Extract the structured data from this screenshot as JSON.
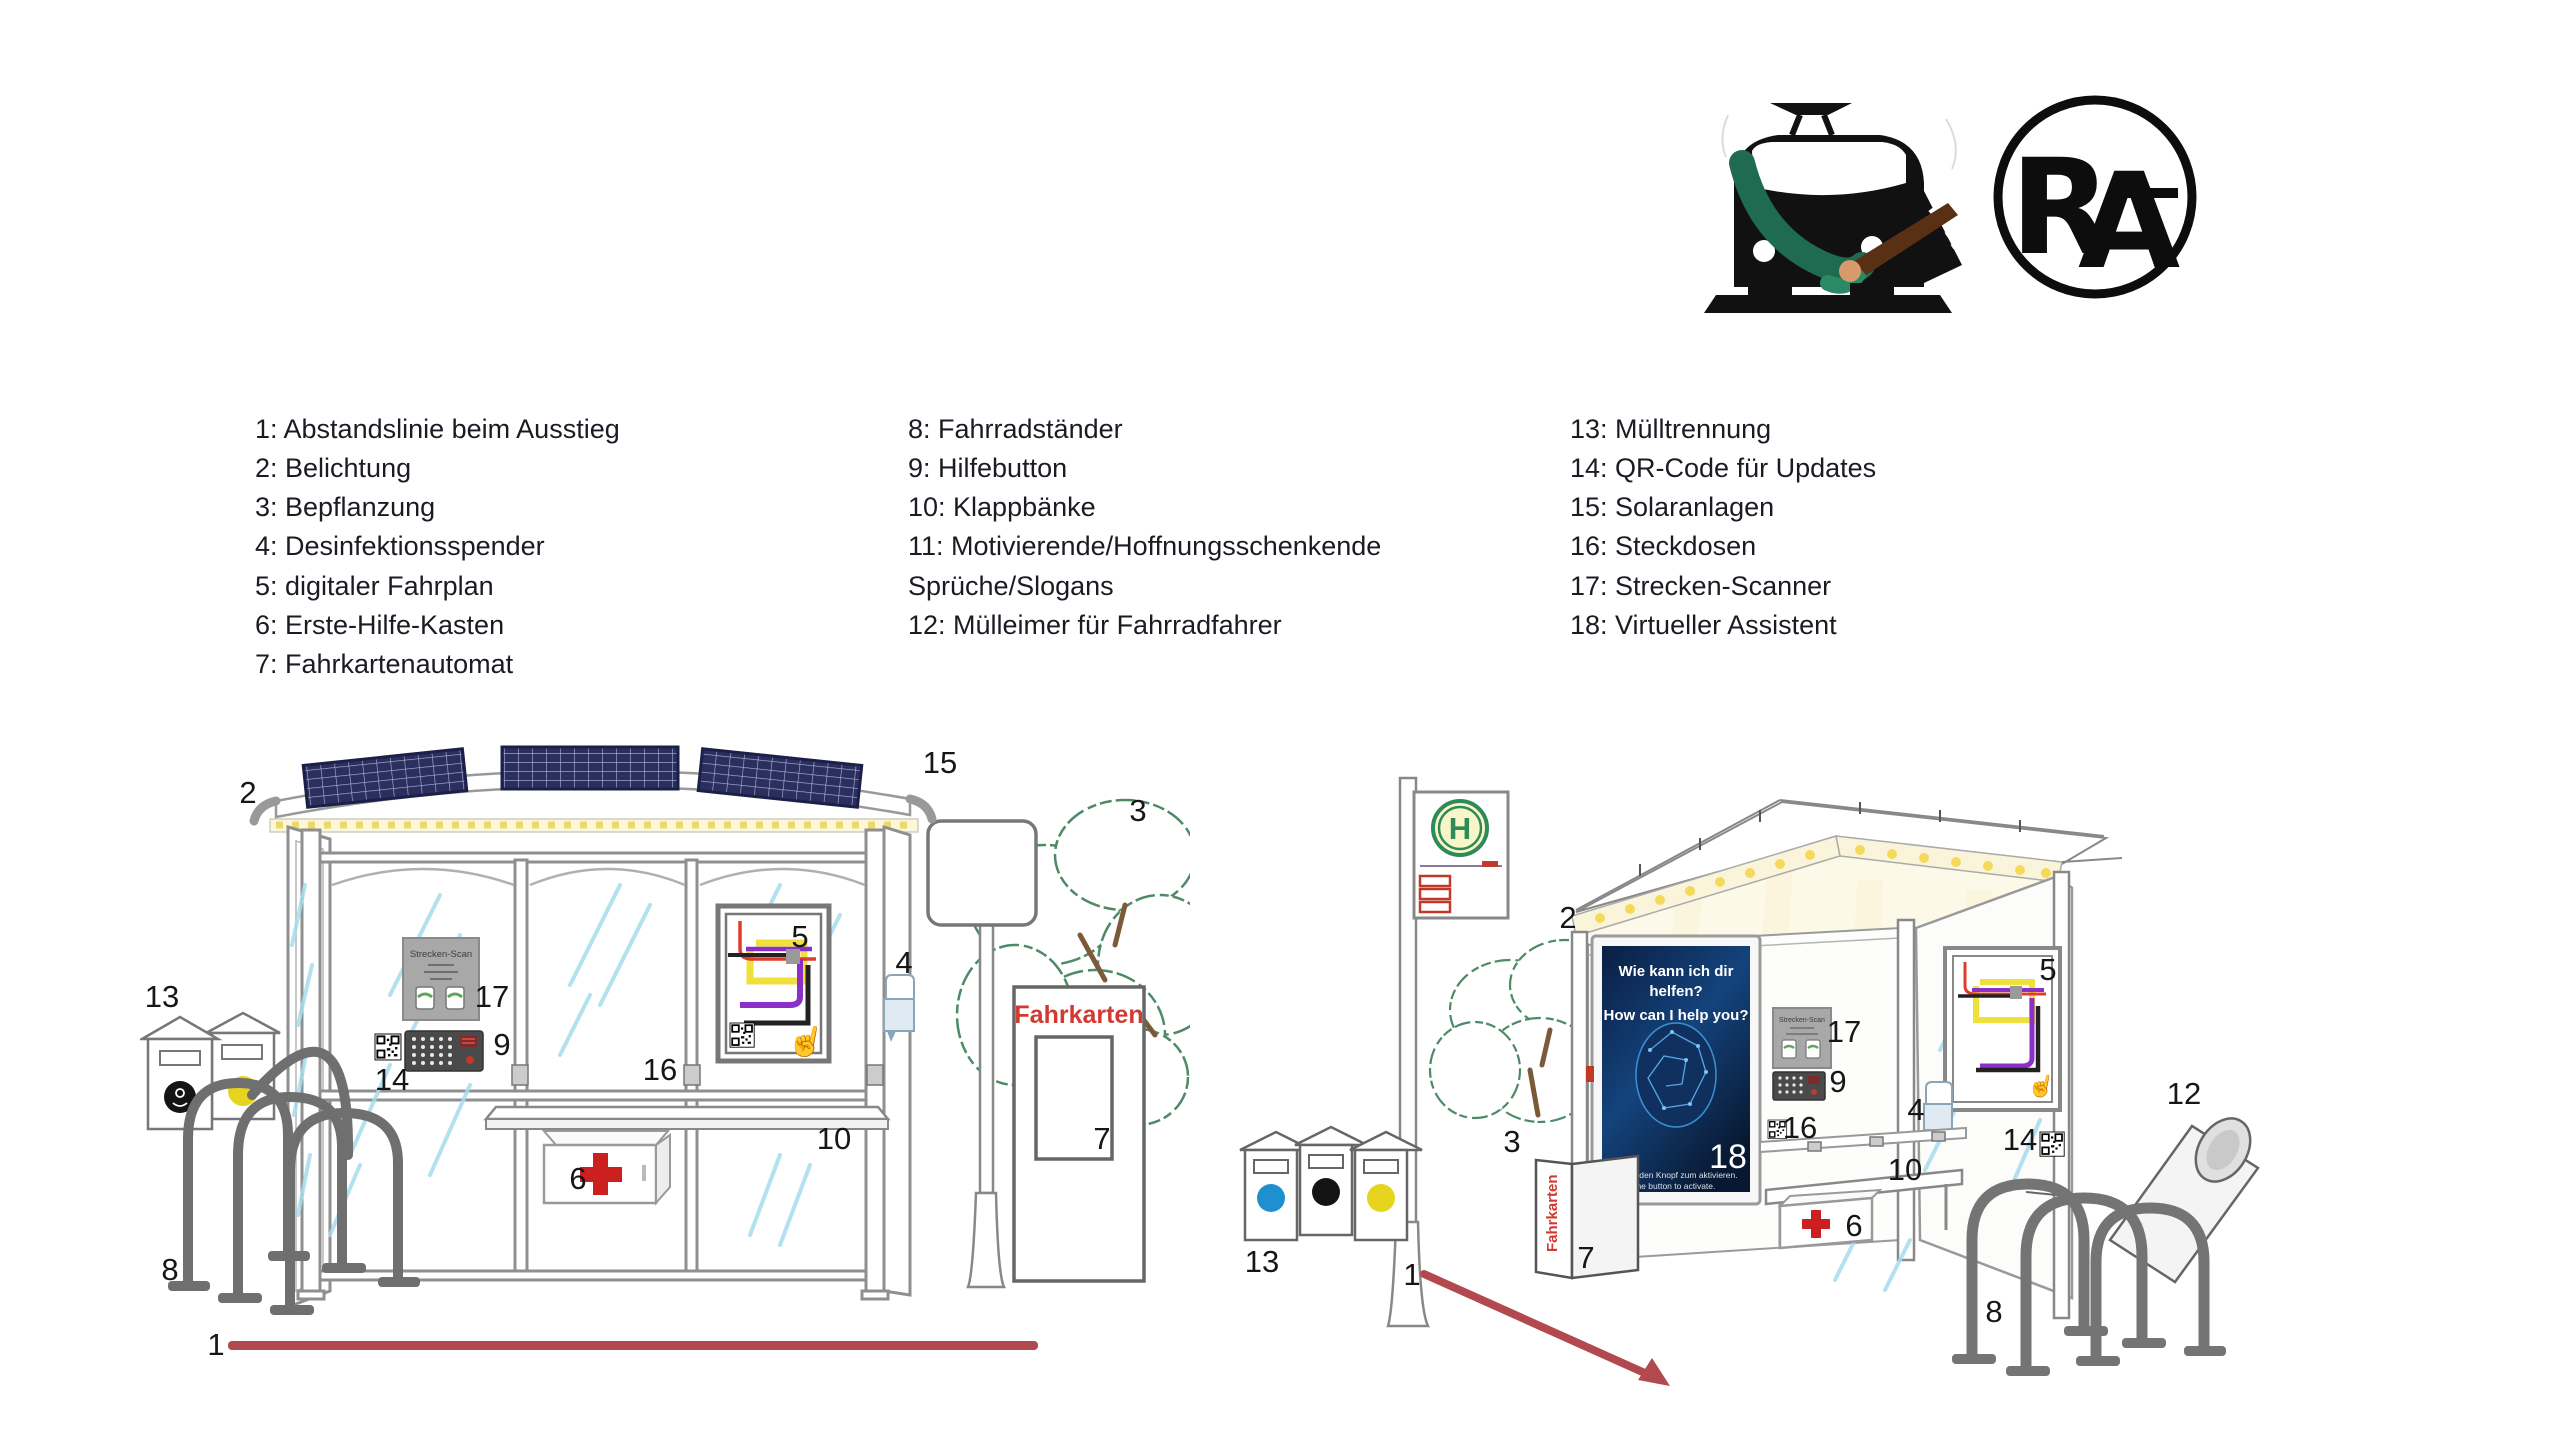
{
  "legend": {
    "col1": [
      "1: Abstandslinie beim Ausstieg",
      "2: Belichtung",
      "3: Bepflanzung",
      "4: Desinfektionsspender",
      "5: digitaler Fahrplan",
      "6: Erste-Hilfe-Kasten",
      "7: Fahrkartenautomat"
    ],
    "col2": [
      "8: Fahrradständer",
      "9: Hilfebutton",
      "10: Klappbänke",
      "11: Motivierende/Hoffnungsschenkende Sprüche/Slogans",
      "12: Mülleimer für Fahrradfahrer"
    ],
    "col3": [
      "13: Mülltrennung",
      "14: QR-Code für Updates",
      "15: Solaranlagen",
      "16: Steckdosen",
      "17: Strecken-Scanner",
      "18: Virtueller Assistent"
    ]
  },
  "logos": {
    "monogram": {
      "letter_r": "R",
      "letter_a": "A"
    }
  },
  "scenes": {
    "left": {
      "strecken_scan": "Strecken-Scan",
      "fahrkarten": "Fahrkarten"
    },
    "right": {
      "h_sign": "H",
      "strecken_scan": "Strecken-Scan",
      "fahrkarten": "Fahrkarten",
      "assistant": {
        "line1_de": "Wie kann ich dir",
        "line2_de": "helfen?",
        "line_en": "How can I help you?",
        "number": "18",
        "hint_de": "Drücke den Knopf zum aktivieren.",
        "hint_en": "Press the button to activate."
      }
    }
  },
  "markers": {
    "left": [
      "2",
      "15",
      "13",
      "17",
      "9",
      "14",
      "16",
      "5",
      "4",
      "10",
      "6",
      "8",
      "3",
      "7",
      "1"
    ],
    "right": [
      "2",
      "13",
      "1",
      "3",
      "7",
      "17",
      "9",
      "16",
      "10",
      "6",
      "4",
      "5",
      "14",
      "8",
      "12"
    ]
  },
  "colors": {
    "accent_red": "#b2494f",
    "ticket_red": "#d03a32",
    "solar_navy": "#2b2f5e",
    "led_yellow": "#f5d95a",
    "tree_green": "#4d8a66",
    "hsign_green": "#2e8b57",
    "screen_blue": "#0d2a55"
  }
}
